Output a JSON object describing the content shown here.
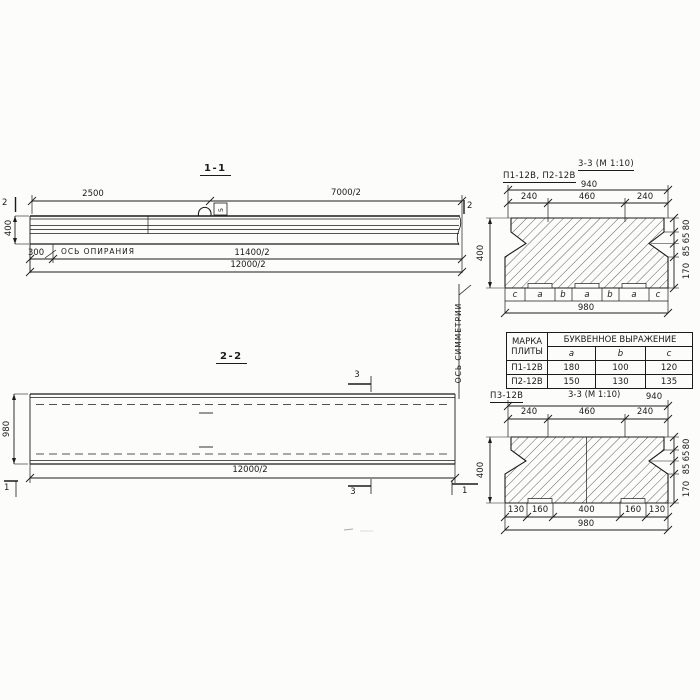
{
  "section_1_1": {
    "title": "1-1",
    "cut_marker": "2",
    "dim_2500": "2500",
    "dim_7000_half": "7000/2",
    "dim_400": "400",
    "dim_300": "300",
    "bearing_axis_label": "ОСЬ ОПИРАНИЯ",
    "dim_11400_half": "11400/2",
    "dim_12000_half": "12000/2",
    "hook_label": "5"
  },
  "section_2_2": {
    "title": "2-2",
    "dim_980": "980",
    "dim_12000_half": "12000/2",
    "cut_marker_3": "3",
    "cut_marker_1": "1"
  },
  "symmetry_axis_label": "ОСЬ СИММЕТРИИ",
  "section_3_3_plates12": {
    "plates_label": "П1-12В, П2-12В",
    "title": "3-3 (М 1:10)",
    "dim_total_top": "940",
    "dims_top": [
      "240",
      "460",
      "240"
    ],
    "dims_right": [
      "80",
      "65",
      "85",
      "170"
    ],
    "dim_left": "400",
    "segment_letters": [
      "c",
      "a",
      "b",
      "a",
      "b",
      "a",
      "c"
    ],
    "dim_total_bottom": "980"
  },
  "table": {
    "col_mark_line1": "МАРКА",
    "col_mark_line2": "ПЛИТЫ",
    "group_header": "БУКВЕННОЕ  ВЫРАЖЕНИЕ",
    "columns": [
      "a",
      "b",
      "c"
    ],
    "rows": [
      {
        "mark": "П1-12В",
        "a": "180",
        "b": "100",
        "c": "120"
      },
      {
        "mark": "П2-12В",
        "a": "150",
        "b": "130",
        "c": "135"
      }
    ]
  },
  "section_3_3_plate3": {
    "plate_label": "П3-12В",
    "title": "3-3 (М 1:10)",
    "dim_total_top": "940",
    "dims_top": [
      "240",
      "460",
      "240"
    ],
    "dims_right": [
      "80",
      "65",
      "85",
      "170"
    ],
    "dim_left": "400",
    "dims_bottom": [
      "130",
      "160",
      "400",
      "160",
      "130"
    ],
    "dim_total_bottom": "980"
  }
}
